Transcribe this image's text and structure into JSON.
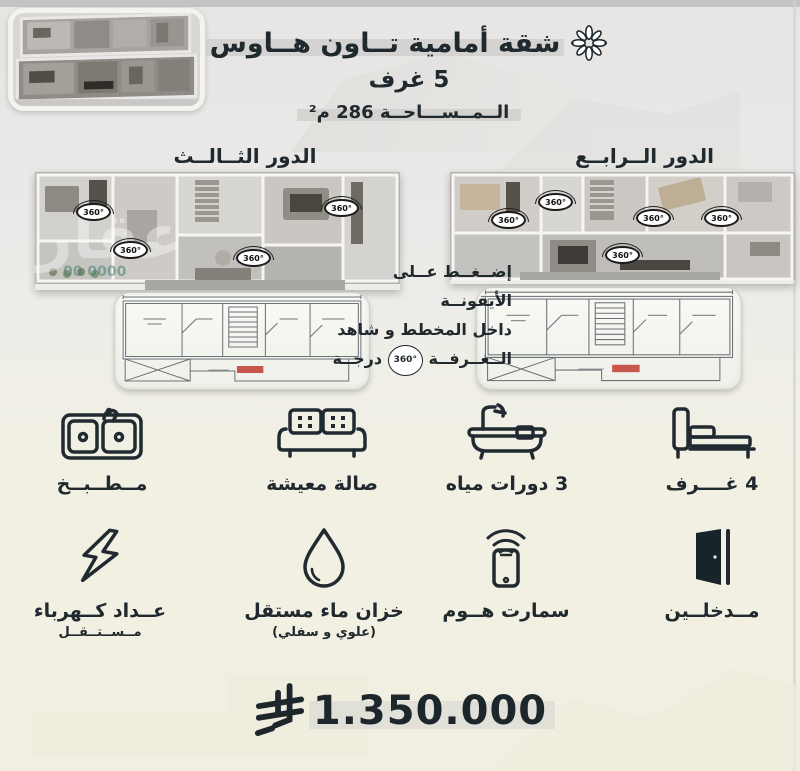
{
  "header": {
    "title": "شقة أمامية تــاون هــاوس",
    "rooms": "5 غرف",
    "area": "الــمــســـاحــة 286 م²"
  },
  "plans": {
    "third_floor_label": "الدور الثــالــث",
    "fourth_floor_label": "الدور الــرابــع",
    "badge_360": "360°",
    "instruction": {
      "line1": "إضــغــط عــلى الأيقونــة",
      "line2": "داخل المخطط و شاهد",
      "line3_start": "الــغــرفــة",
      "line3_badge": "360°",
      "line3_end": "درجــة"
    }
  },
  "watermark": {
    "brand": "عقار",
    "digits": "00 0000"
  },
  "amenities": {
    "row1": [
      {
        "icon": "kitchen-sink-icon",
        "label": "مــطــبــخ",
        "sub": ""
      },
      {
        "icon": "sofa-icon",
        "label": "صالة معيشة",
        "sub": ""
      },
      {
        "icon": "bathtub-icon",
        "label": "3 دورات مياه",
        "sub": ""
      },
      {
        "icon": "bed-icon",
        "label": "4 غــــرف",
        "sub": ""
      }
    ],
    "row2": [
      {
        "icon": "lightning-bolt-icon",
        "label": "عــداد كــهرباء",
        "sub": "مــســتــقــل"
      },
      {
        "icon": "water-drop-icon",
        "label": "خزان ماء مستقل",
        "sub": "(علوي و سفلي)"
      },
      {
        "icon": "smartphone-wifi-icon",
        "label": "سمارت هــوم",
        "sub": ""
      },
      {
        "icon": "open-door-icon",
        "label": "مــدخلــين",
        "sub": ""
      }
    ]
  },
  "price": {
    "amount": "1.350.000",
    "currency_icon": "saudi-riyal-icon"
  },
  "colors": {
    "ink": "#20292e",
    "cream_bg": "#f1efe2",
    "gray_bg": "#e8e7e5",
    "highlight_band": "#cfcecc",
    "blueprint_red": "#c23b2e"
  }
}
